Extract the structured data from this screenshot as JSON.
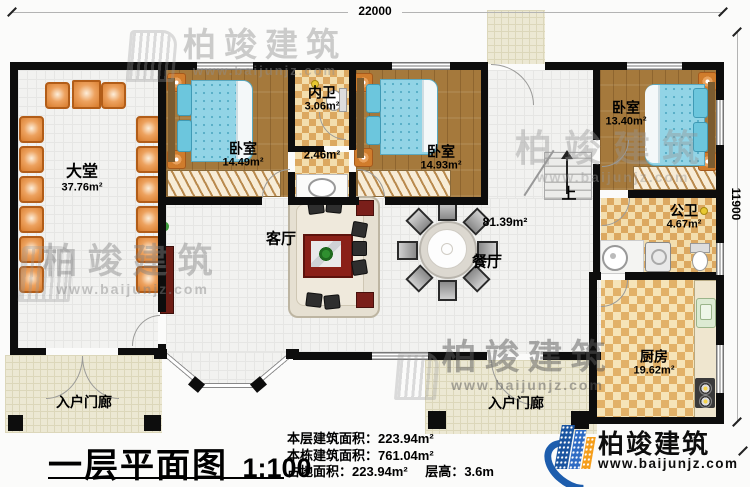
{
  "dimensions": {
    "width_label": "22000",
    "height_label": "11900"
  },
  "rooms": {
    "datang": {
      "name": "大堂",
      "area": "37.76m²"
    },
    "bedroom1": {
      "name": "卧室",
      "area": "14.49m²"
    },
    "neiwei": {
      "name": "内卫",
      "area": "3.06m²"
    },
    "corridor": {
      "area": "2.46m²"
    },
    "bedroom2": {
      "name": "卧室",
      "area": "14.93m²"
    },
    "bedroom3": {
      "name": "卧室",
      "area": "13.40m²"
    },
    "gongwei": {
      "name": "公卫",
      "area": "4.67m²"
    },
    "kitchen": {
      "name": "厨房",
      "area": "19.62m²"
    },
    "living": {
      "name": "客厅"
    },
    "dining": {
      "name": "餐厅"
    },
    "open_area": {
      "area": "81.39m²"
    },
    "porch_left": {
      "name": "入户门廊"
    },
    "porch_mid": {
      "name": "入户门廊"
    },
    "stairs": {
      "label": "上"
    }
  },
  "titleblock": {
    "title": "一层平面图",
    "scale": "1:100",
    "stats": [
      {
        "label": "本层建筑面积：",
        "value": "223.94m²"
      },
      {
        "label": "本栋建筑面积：",
        "value": "761.04m²"
      },
      {
        "label": "占地面积：",
        "value": "223.94m²",
        "label2": "层高：",
        "value2": "3.6m"
      }
    ]
  },
  "logo": {
    "name": "柏竣建筑",
    "url": "www.baijunjz.com"
  },
  "watermark": {
    "name": "柏竣建筑",
    "url": "www.baijunjz.com"
  },
  "colors": {
    "wall": "#0d0d0d",
    "wood_floor": "#a5793c",
    "checker_floor": "#dca860",
    "bed_blue": "#92d4e6",
    "chair_orange": "#d97e2f",
    "porch": "#ece8d3",
    "logo_blue": "#1d5dad",
    "logo_orange": "#f59e1b",
    "accent_red": "#7a1f1a"
  }
}
